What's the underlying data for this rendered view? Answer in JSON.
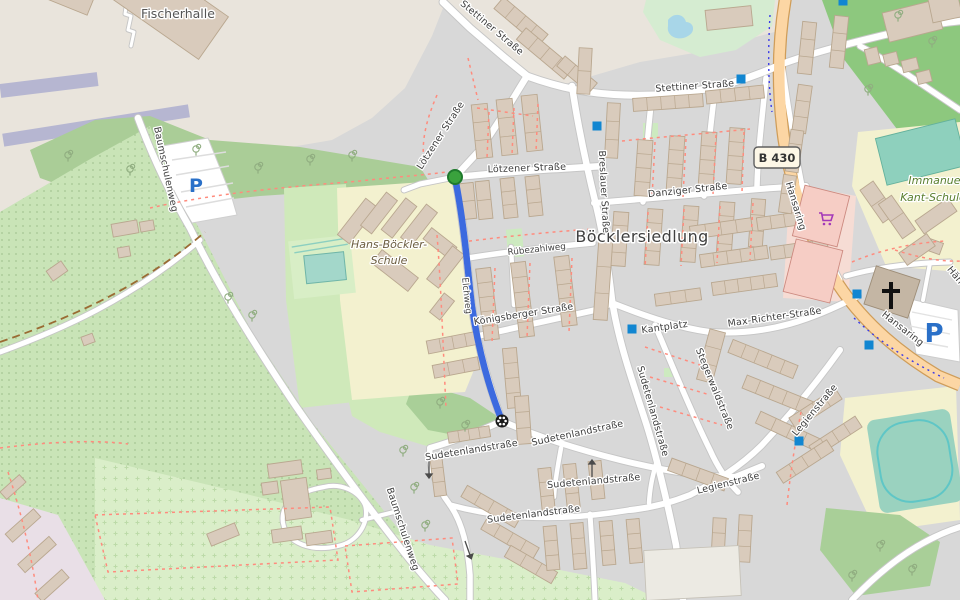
{
  "labels": {
    "place": {
      "fischerhalle": "Fischerhalle",
      "district": "Böcklersiedlung"
    },
    "school_left": {
      "line1": "Hans-Böckler-",
      "line2": "Schule"
    },
    "school_right": {
      "line1": "Immanuel-",
      "line2": "Kant-Schule"
    },
    "fragment": {
      "text": "Hän"
    },
    "streets": [
      {
        "text": "Stettiner Straße"
      },
      {
        "text": "Stettiner Straße"
      },
      {
        "text": "Lötzener Straße"
      },
      {
        "text": "Lötzener Straße"
      },
      {
        "text": "Breslauer Straße"
      },
      {
        "text": "Danziger Straße"
      },
      {
        "text": "Rübezahlweg"
      },
      {
        "text": "Elchweg"
      },
      {
        "text": "Königsberger Straße"
      },
      {
        "text": "Kantplatz"
      },
      {
        "text": "Max-Richter-Straße"
      },
      {
        "text": "Stegerwaldstraße"
      },
      {
        "text": "Sudetenlandstraße"
      },
      {
        "text": "Legienstraße"
      },
      {
        "text": "Legienstraße"
      },
      {
        "text": "Sudetenlandstraße"
      },
      {
        "text": "Sudetenlandstraße"
      },
      {
        "text": "Sudetenlandstraße"
      },
      {
        "text": "Sudetenlandstraße"
      },
      {
        "text": "Baumschulenweg"
      },
      {
        "text": "Baumschulenweg"
      },
      {
        "text": "Hansaring"
      },
      {
        "text": "Hansaring"
      }
    ]
  },
  "road_shield": {
    "text": "B 430"
  },
  "icons": {
    "parking_letter": "P",
    "bus_stop_color": "#1186d1",
    "cart_color": "#a438b8",
    "church_cross_color": "#111111"
  },
  "route": {
    "color": "#3c6adf",
    "start_color": "#3aa23d",
    "start_border": "#1f7a2d",
    "end_icon_color": "#1a1a1a"
  }
}
